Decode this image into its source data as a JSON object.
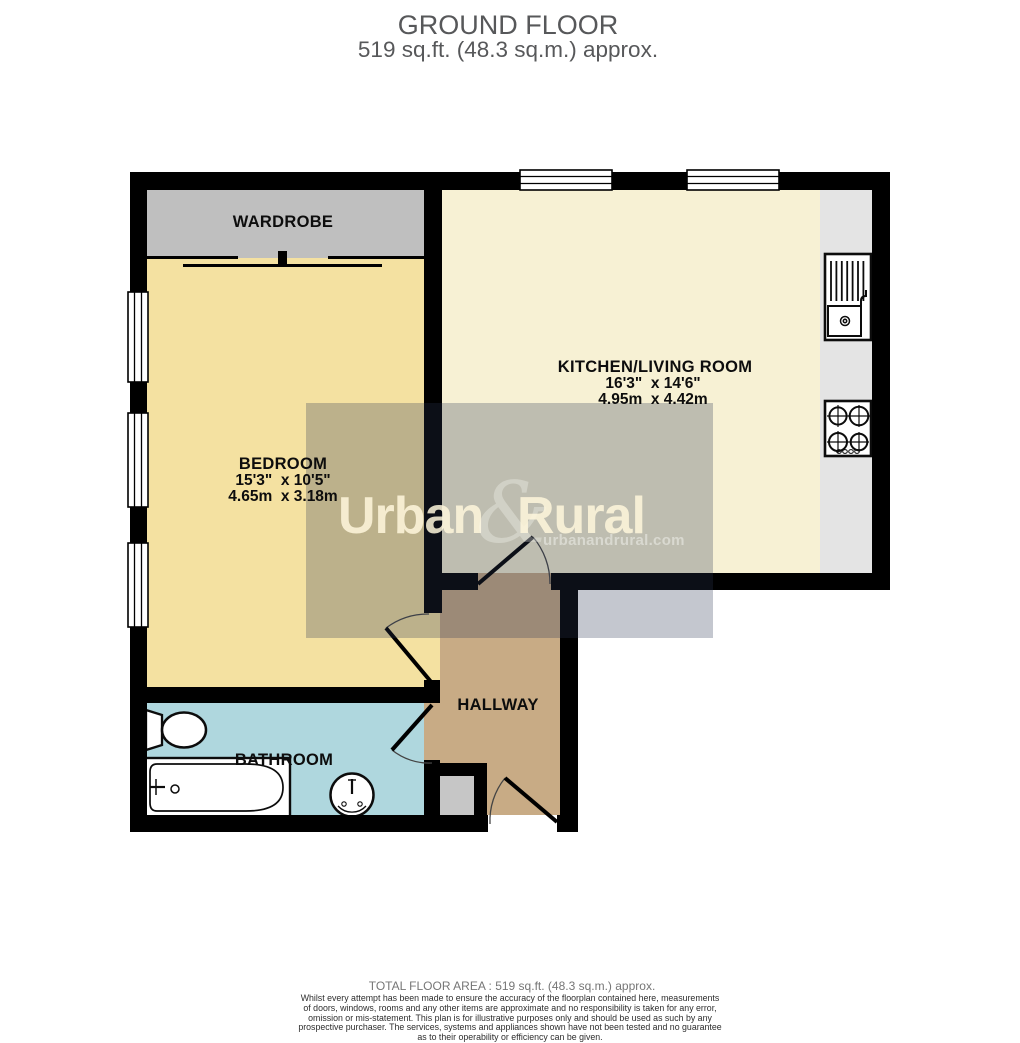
{
  "title": {
    "line1": "GROUND FLOOR",
    "line2": "519 sq.ft. (48.3 sq.m.) approx."
  },
  "rooms": {
    "wardrobe": {
      "name": "WARDROBE"
    },
    "bedroom": {
      "name": "BEDROOM",
      "dims_imperial": "15'3\"  x 10'5\"",
      "dims_metric": "4.65m  x 3.18m"
    },
    "kitchen_living": {
      "name": "KITCHEN/LIVING ROOM",
      "dims_imperial": "16'3\"  x 14'6\"",
      "dims_metric": "4.95m  x 4.42m"
    },
    "hallway": {
      "name": "HALLWAY"
    },
    "bathroom": {
      "name": "BATHROOM"
    }
  },
  "watermark": {
    "brand_left": "Urban",
    "brand_amp": "&",
    "brand_right": "Rural",
    "website": "urbanandrural.com"
  },
  "footer": {
    "total": "TOTAL FLOOR AREA : 519 sq.ft. (48.3 sq.m.) approx.",
    "disclaimer_lines": [
      "Whilst every attempt has been made to ensure the accuracy of the floorplan contained here, measurements",
      "of doors, windows, rooms and any other items are approximate and no responsibility is taken for any error,",
      "omission or mis-statement. This plan is for illustrative purposes only and should be used as such by any",
      "prospective purchaser. The services, systems and appliances shown have not been tested and no guarantee",
      "as to their operability or efficiency can be given."
    ],
    "credit": "Made with Metropix ©2026"
  },
  "colors": {
    "wall": "#000000",
    "bedroom_fill": "#f4e1a1",
    "kitchen_fill": "#f7f1d4",
    "wardrobe_fill": "#bfbfbf",
    "counter_fill": "#e4e4e4",
    "hallway_fill": "#c8ab85",
    "bathroom_fill": "#afd7de",
    "cupboard_fill": "#c6c6c6",
    "watermark_overlay": "rgba(44,54,84,0.28)",
    "title_gray": "#57585a"
  }
}
